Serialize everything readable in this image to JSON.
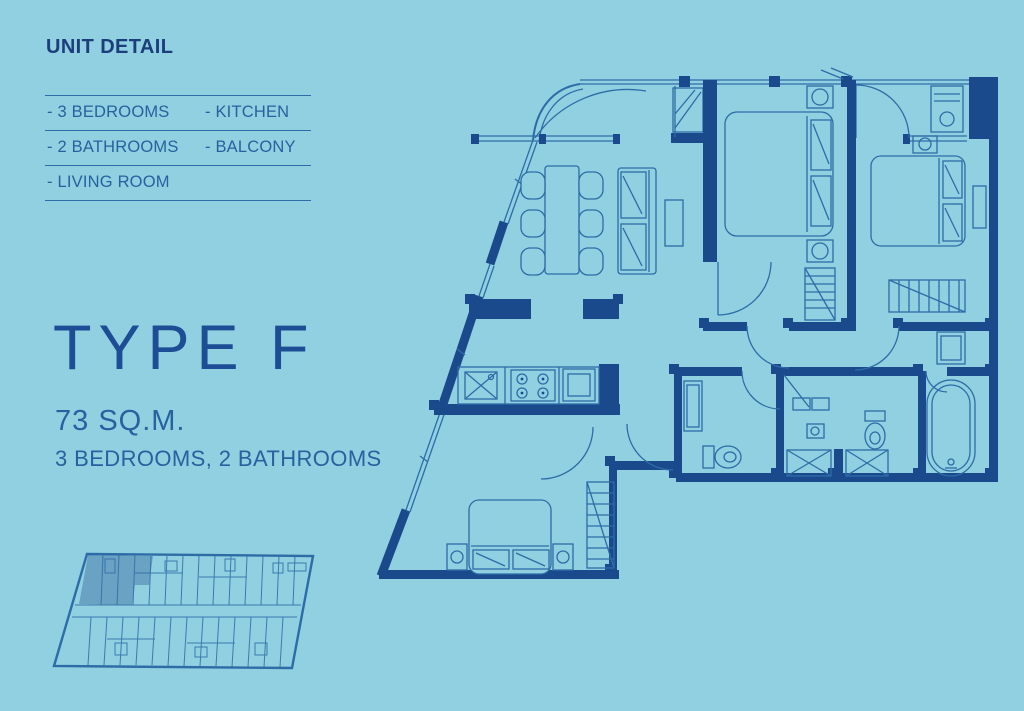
{
  "colors": {
    "bg": "#90D0E0",
    "wall": "#1B4A8C",
    "line": "#2E6CA7",
    "heading": "#1C3E7B",
    "title": "#1D4D95",
    "body": "#28619F"
  },
  "panel": {
    "heading": "UNIT DETAIL",
    "features": {
      "rows": [
        {
          "left": "- 3 BEDROOMS",
          "right": "- KITCHEN"
        },
        {
          "left": "- 2 BATHROOMS",
          "right": "- BALCONY"
        },
        {
          "left": "- LIVING ROOM",
          "right": ""
        }
      ]
    },
    "type_title": "TYPE F",
    "area": "73 SQ.M.",
    "summary": "3 BEDROOMS, 2 BATHROOMS"
  }
}
